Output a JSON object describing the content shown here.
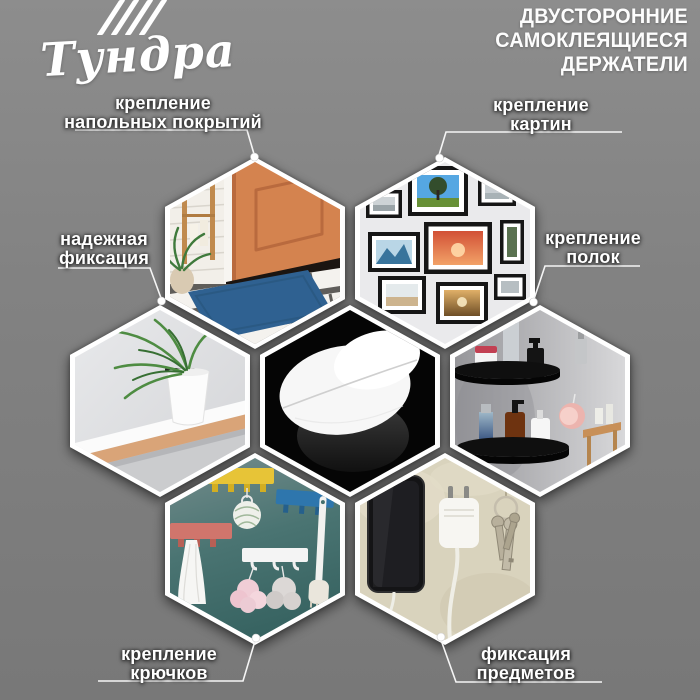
{
  "brand": {
    "logo_text": "Тундра",
    "logo_mark": "four-slashes"
  },
  "header": {
    "title_lines": [
      "ДВУСТОРОННИЕ",
      "САМОКЛЕЯЩИЕСЯ",
      "ДЕРЖАТЕЛИ"
    ]
  },
  "callouts": [
    {
      "id": "floor-coverings",
      "lines": [
        "крепление",
        "напольных покрытий"
      ]
    },
    {
      "id": "pictures",
      "lines": [
        "крепление",
        "картин"
      ]
    },
    {
      "id": "secure-fixation",
      "lines": [
        "надежная",
        "фиксация"
      ]
    },
    {
      "id": "shelves",
      "lines": [
        "крепление",
        "полок"
      ]
    },
    {
      "id": "hooks",
      "lines": [
        "крепление",
        "крючков"
      ]
    },
    {
      "id": "objects",
      "lines": [
        "фиксация",
        "предметов"
      ]
    }
  ],
  "hexagons": [
    {
      "id": "doormat",
      "depicts": "entryway with orange front door, blue doormat, lantern and plant"
    },
    {
      "id": "picture-wall",
      "depicts": "gallery wall of black framed photos"
    },
    {
      "id": "plant-shelf",
      "depicts": "palm plant in white pot on wall-mounted shelf"
    },
    {
      "id": "product",
      "depicts": "white round double-sided adhesive holders on black background"
    },
    {
      "id": "bathroom-shelf",
      "depicts": "black corner shelves with cosmetics and bottles"
    },
    {
      "id": "hook-rails",
      "depicts": "colored hook rails with towel, sponges and brush"
    },
    {
      "id": "phone-charger",
      "depicts": "phone, wall charger and keys fixed to a wall"
    }
  ],
  "colors": {
    "background": "#828282",
    "text": "#ffffff",
    "door_orange": "#d4834f",
    "rug_blue": "#2f6191",
    "rail_yellow": "#e7c437",
    "rail_blue": "#2e76ad",
    "rail_coral": "#d0756c",
    "shelf_black": "#0f0f0f",
    "product_bg": "#050505"
  }
}
